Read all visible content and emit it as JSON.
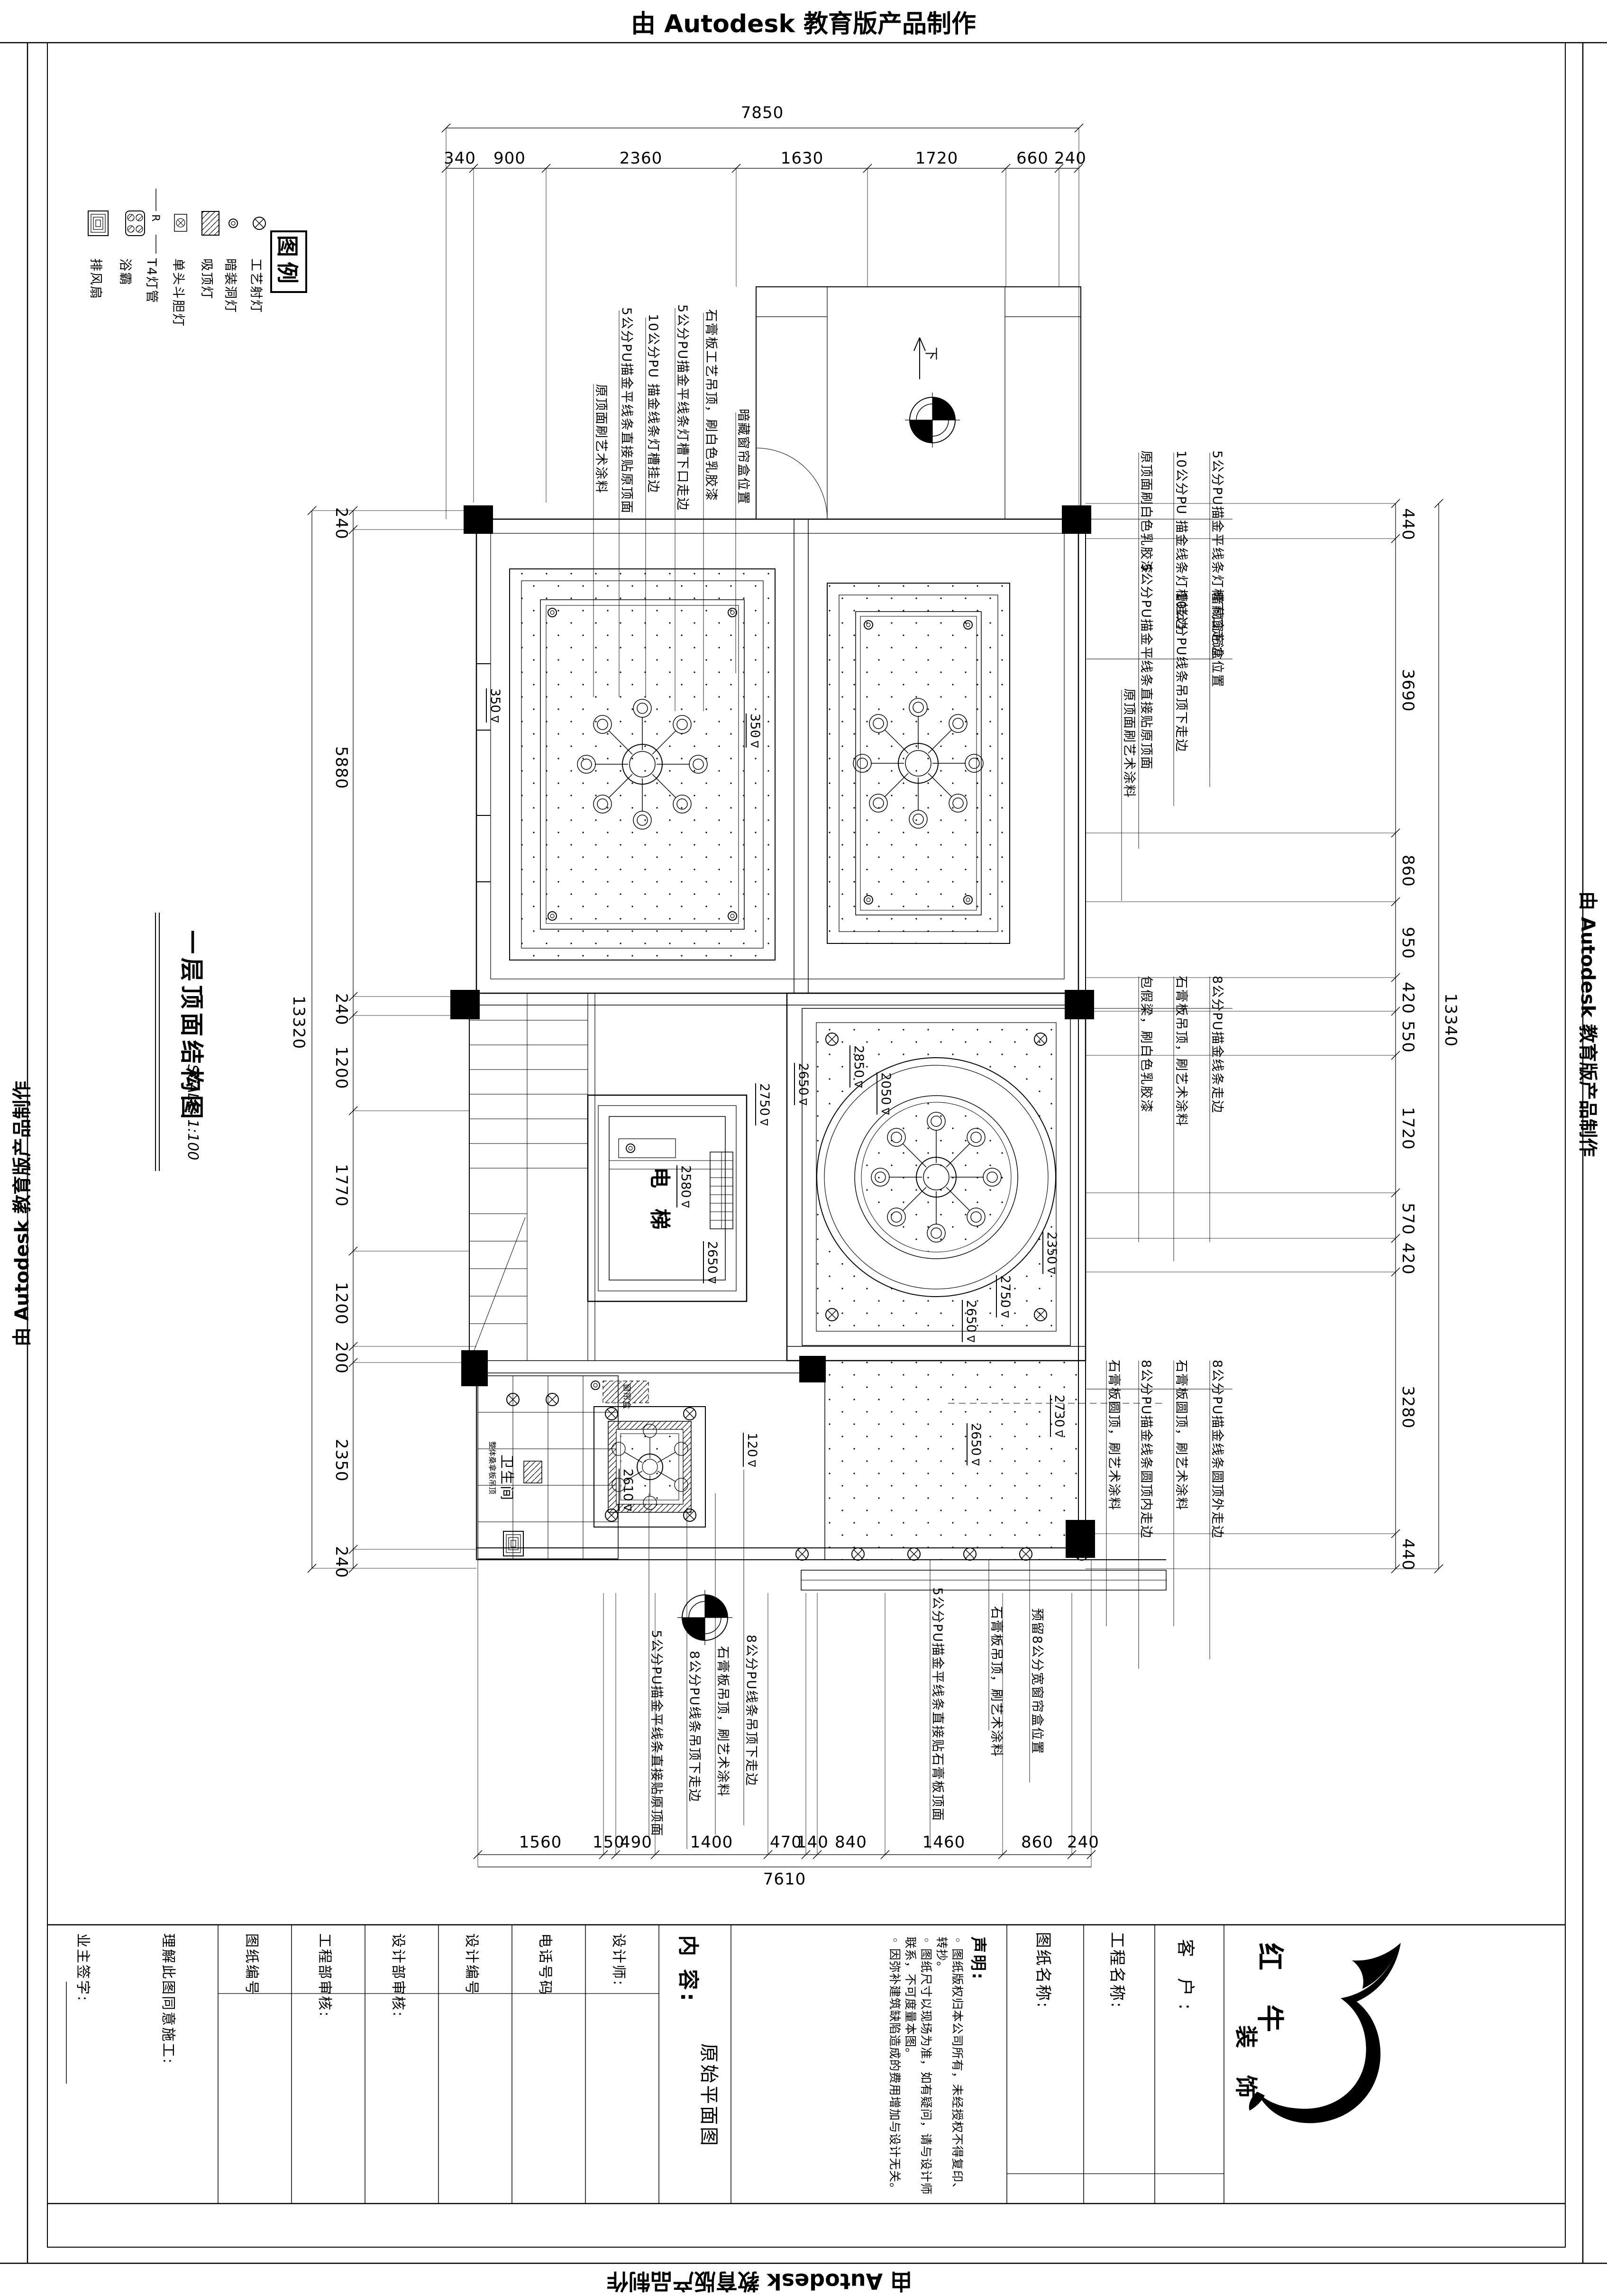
{
  "stamp": "由 Autodesk 教育版产品制作",
  "legend": {
    "title": "图例",
    "items": [
      {
        "icon": "craft-spotlight-icon",
        "label": "工艺射灯"
      },
      {
        "icon": "recessed-downlight-icon",
        "label": "暗装洞灯"
      },
      {
        "icon": "ceiling-lamp-icon",
        "label": "吸顶灯"
      },
      {
        "icon": "single-head-lamp-icon",
        "label": "单头斗胆灯"
      },
      {
        "icon": "t4-tube-icon",
        "label": "T4灯管"
      },
      {
        "icon": "bath-heater-icon",
        "label": "浴霸"
      },
      {
        "icon": "exhaust-fan-icon",
        "label": "排风扇"
      }
    ]
  },
  "title": {
    "name": "一层顶面结构图",
    "scale": "SCALE: 1:100"
  },
  "dims": {
    "top": {
      "total": "7850",
      "segments": [
        "340",
        "900",
        "2360",
        "1630",
        "1720",
        "660",
        "240"
      ]
    },
    "bottom": {
      "total": "7610",
      "segments": [
        "1560",
        "150",
        "490",
        "1400",
        "470",
        "140",
        "840",
        "1460",
        "860",
        "240"
      ]
    },
    "left": {
      "total": "13320",
      "segments": [
        "240",
        "5880",
        "240",
        "1200",
        "1770",
        "1200",
        "200",
        "2350",
        "240"
      ]
    },
    "right": {
      "total": "13340",
      "segments": [
        "440",
        "3690",
        "860",
        "950",
        "420",
        "550",
        "1720",
        "570",
        "420",
        "3280",
        "440"
      ]
    }
  },
  "annotations": {
    "top_left": [
      "原顶面刷艺术涂料",
      "5公分PU描金平线条直接贴原顶面",
      "10公分PU 描金线条灯槽挂边",
      "5公分PU描金平线条灯槽下口走边",
      "石膏板工艺吊顶，刷白色乳胶漆",
      "暗藏窗帘盒位置"
    ],
    "right_1": [
      "5公分PU描金平线条灯槽下口走边",
      "10公分PU 描金线条灯槽挂边",
      "原顶面刷白色乳胶漆"
    ],
    "right_2": [
      "暗藏窗帘盒位置",
      "10公分PU线条吊顶下走边",
      "5公分PU描金平线条直接贴原顶面",
      "原顶面刷艺术涂料"
    ],
    "right_3": [
      "8公分PU描金线条走边",
      "石膏板吊顶，刷艺术涂料",
      "包假梁，刷白色乳胶漆"
    ],
    "right_4": [
      "8公分PU描金线条圆顶外走边",
      "石膏板圆顶，刷艺术涂料",
      "8公分PU描金线条圆顶内走边",
      "石膏板圆顶，刷艺术涂料"
    ],
    "bottom": [
      "5公分PU描金平线条直接贴原顶面",
      "8公分PU线条吊顶下走边",
      "石膏板吊顶，刷艺术涂料",
      "8公分PU线条吊顶下走边",
      "5公分PU描金平线条直接贴石膏板顶面",
      "石膏板吊顶，刷艺术涂料",
      "预留8公分宽窗帘盒位置"
    ]
  },
  "levels": [
    "2580",
    "2650",
    "2750",
    "2850",
    "2050",
    "2650",
    "2350",
    "2650",
    "2750",
    "2730",
    "2650",
    "2610",
    "350",
    "350",
    "120"
  ],
  "rooms": {
    "elevator": "电 梯",
    "bathroom": "卫生间",
    "bathroom_note": "整体桑拿板吊顶",
    "curtain_box": "窗帘盒",
    "stair_down": "下"
  },
  "titleblock": {
    "company_name_1": "红 牛",
    "company_name_2": "装 饰",
    "client": "客  户:",
    "project_name": "工程名称:",
    "drawing_name": "图纸名称:",
    "declaration_title": "声明:",
    "declaration_items": [
      "图纸版权归本公司所有，未经授权不得复印、转抄。",
      "图纸尺寸以现场为准，如有疑问，请与设计师联系，不可度量本图。",
      "因弥补建筑缺陷造成的费用增加与设计无关。"
    ],
    "content_label": "内 容:",
    "content_value": "原始平面图",
    "designer": "设计师:",
    "phone": "电话号码",
    "design_no": "设计编号",
    "design_dept_review": "设计部审核:",
    "engineering_dept_review": "工程部审核:",
    "drawing_no": "图纸编号",
    "agree": "理解此图同意施工:",
    "owner_sign": "业主签字:"
  }
}
